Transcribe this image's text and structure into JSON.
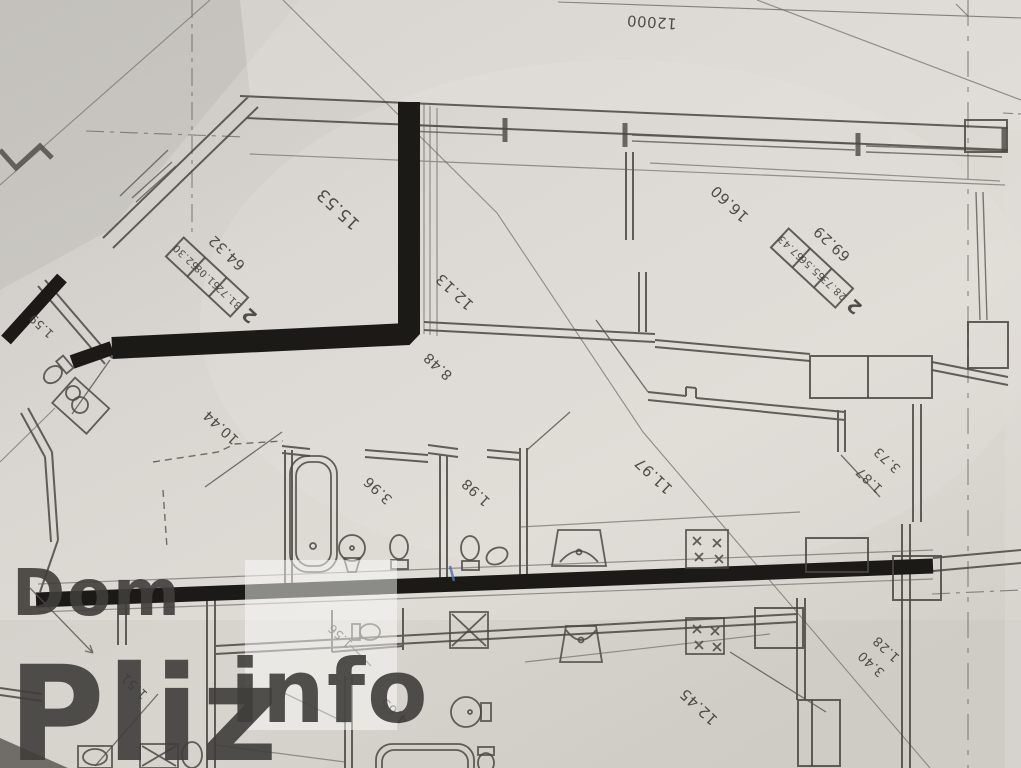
{
  "watermark": {
    "line1": "Dom",
    "line2": "Pliz",
    "line3": "info"
  },
  "top_dimension": {
    "value": "12000"
  },
  "stamps": [
    {
      "unit": "2",
      "cells": [
        "31.72",
        "61.08",
        "62.30"
      ],
      "total": "64.32"
    },
    {
      "unit": "2",
      "cells": [
        "28.73",
        "65.56",
        "67.43"
      ],
      "total": "69.29"
    }
  ],
  "labels": [
    "15.53",
    "12.13",
    "8.48",
    "16.60",
    "1.59",
    "10.44",
    "3.96",
    "1.98",
    "11.97",
    "1.87",
    "3.73",
    "1.51",
    "1.56",
    "4.65",
    "12.45",
    "1.28",
    "3.40"
  ],
  "colors": {
    "paper": "#d8d5cf",
    "pencil": "#4a4742",
    "marker_highlight": "#1b1a17",
    "watermark": "#ffffff",
    "pen_mark": "#4f74ac"
  }
}
